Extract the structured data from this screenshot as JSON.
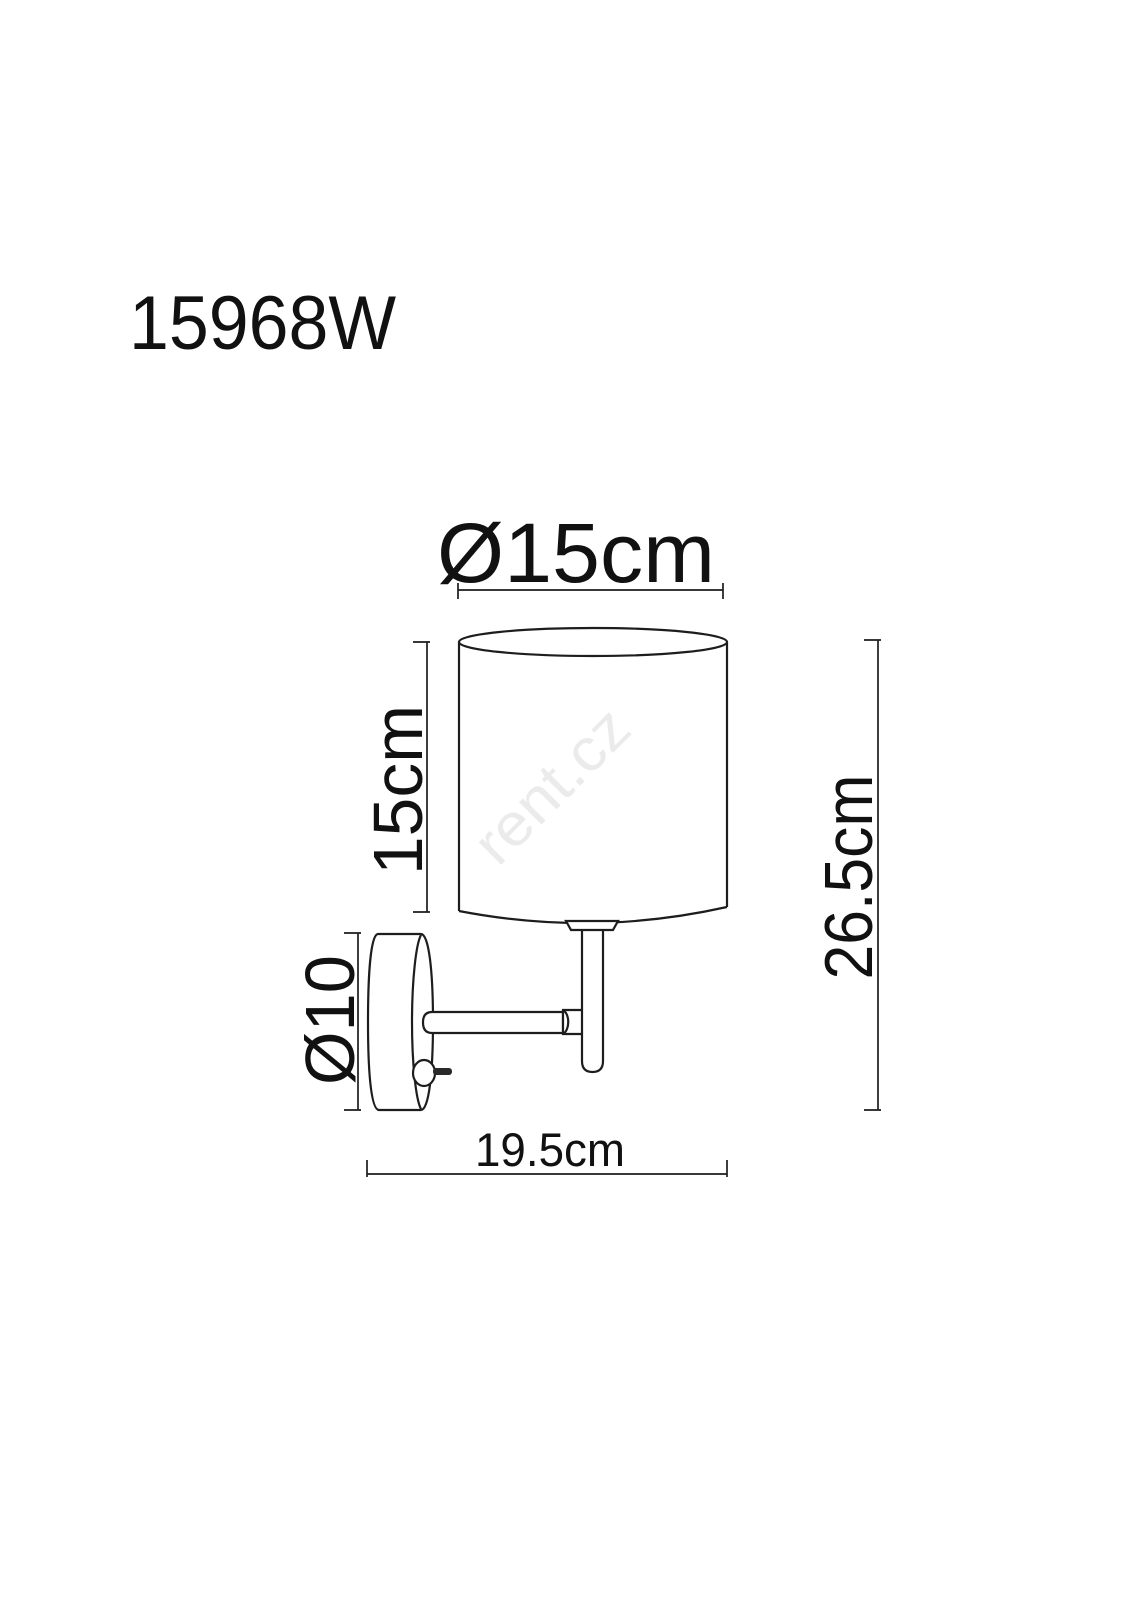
{
  "page": {
    "background_color": "#ffffff"
  },
  "drawing": {
    "product_code": "15968W",
    "watermark_text": "rent.cz",
    "labels": {
      "shade_diameter": "Ø15cm",
      "shade_height": "15cm",
      "base_plate_diameter": "Ø10",
      "overall_height": "26.5cm",
      "overall_depth": "19.5cm"
    },
    "colors": {
      "line_color": "#1d1d1d",
      "text_color": "#111111",
      "watermark_color": "#ebebeb"
    }
  }
}
